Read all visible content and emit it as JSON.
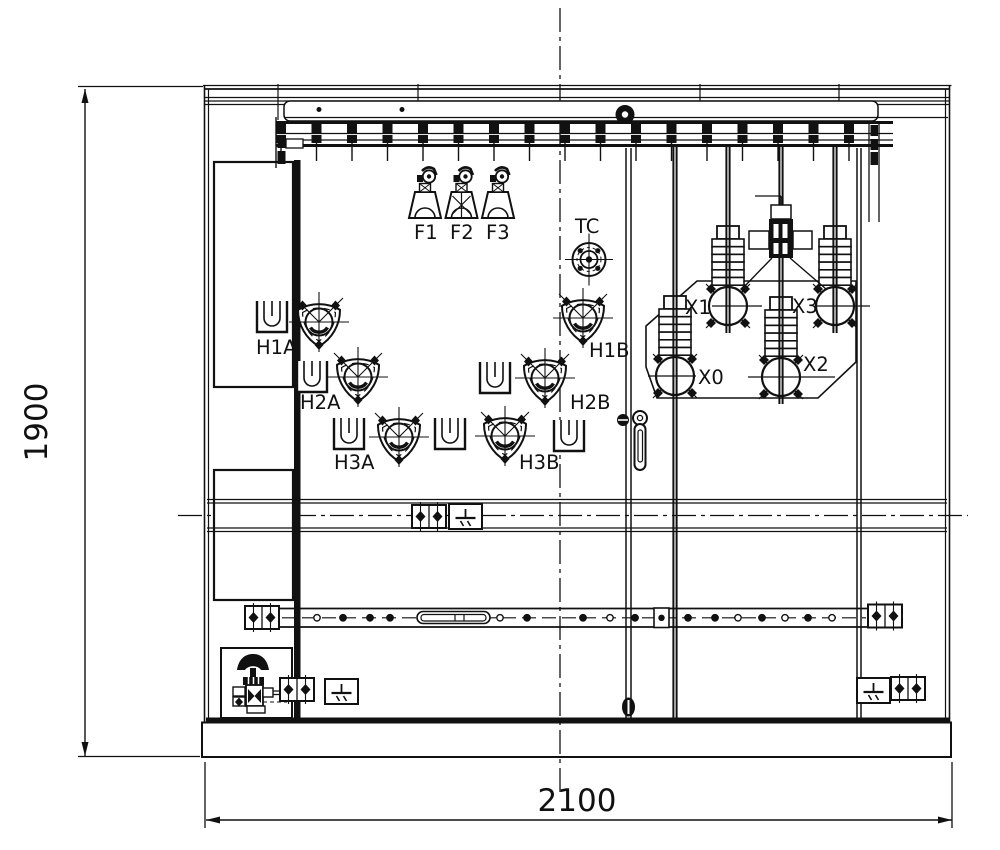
{
  "dimensions": {
    "height": "1900",
    "width": "2100"
  },
  "fuses": {
    "f1": "F1",
    "f2": "F2",
    "f3": "F3"
  },
  "tc": {
    "label": "TC"
  },
  "hv": {
    "h1a": "H1A",
    "h2a": "H2A",
    "h3a": "H3A",
    "h3b": "H3B",
    "h2b": "H2B",
    "h1b": "H1B"
  },
  "lv": {
    "x0": "X0",
    "x1": "X1",
    "x2": "X2",
    "x3": "X3"
  },
  "colors": {
    "line": "#111111",
    "background": "#ffffff"
  }
}
